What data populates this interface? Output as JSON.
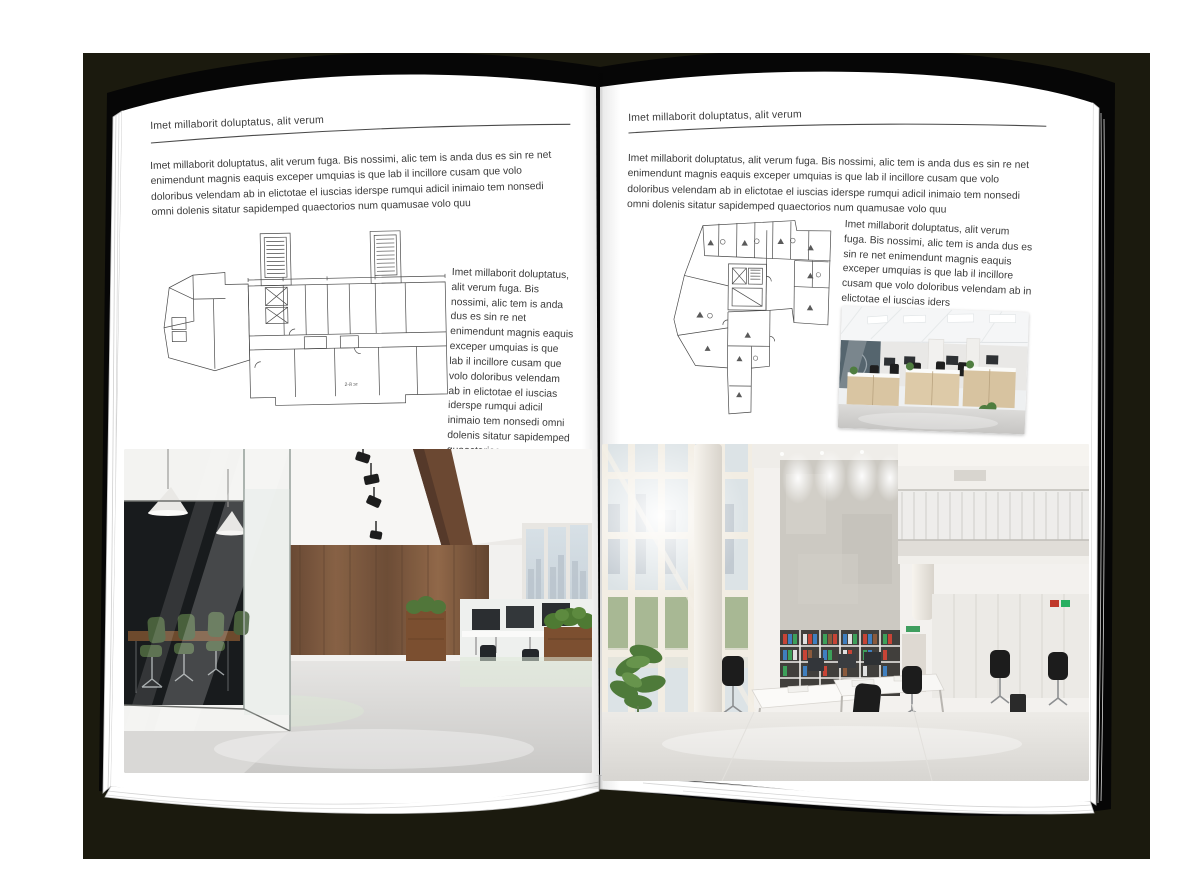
{
  "mockup": {
    "backdrop_color": "#1b1a0e",
    "cover_color": "#060606",
    "page_color": "#ffffff"
  },
  "left_page": {
    "header": "Imet millaborit doluptatus, alit verum",
    "intro": "Imet millaborit doluptatus, alit verum fuga. Bis nossimi, alic tem is anda dus es sin re net enimendunt magnis eaquis exceper umquias is que lab il incillore cusam que volo doloribus velendam ab in elictotae el iuscias iderspe rumqui adicil inimaio tem nonsedi omni dolenis sitatur sapidemped quaectorios num quamusae volo quu",
    "side_text": "Imet millaborit doluptatus, alit verum fuga. Bis nossimi, alic tem is anda dus es sin re net enimendunt magnis eaquis exceper umquias is que lab il incillore cusam que volo doloribus velendam ab in elictotae el iuscias iderspe rumqui adicil inimaio tem nonsedi omni dolenis sitatur sapidemped quaectorios num quamusae volo quu",
    "plan_label": "2-й эт"
  },
  "right_page": {
    "header": "Imet millaborit doluptatus, alit verum",
    "intro": "Imet millaborit doluptatus, alit verum fuga. Bis nossimi, alic tem is anda dus es sin re net enimendunt magnis eaquis exceper umquias is que lab il incillore cusam que volo doloribus velendam ab in elictotae el iuscias iderspe rumqui adicil inimaio tem nonsedi omni dolenis sitatur sapidemped quaectorios num quamusae volo quu",
    "side_text": "Imet millaborit doluptatus, alit verum fuga. Bis nossimi, alic tem is anda dus es sin re net eni­mendunt magnis eaquis exceper umquias is que lab il incillore cusam que volo doloribus velendam ab in elictotae el iuscias iders"
  },
  "figures": {
    "left_floor_plan": "architectural-floor-plan",
    "right_floor_plan": "architectural-floor-plan",
    "left_photo": "office-interior-photo",
    "right_photo": "office-interior-photo",
    "small_photo": "office-interior-photo"
  }
}
